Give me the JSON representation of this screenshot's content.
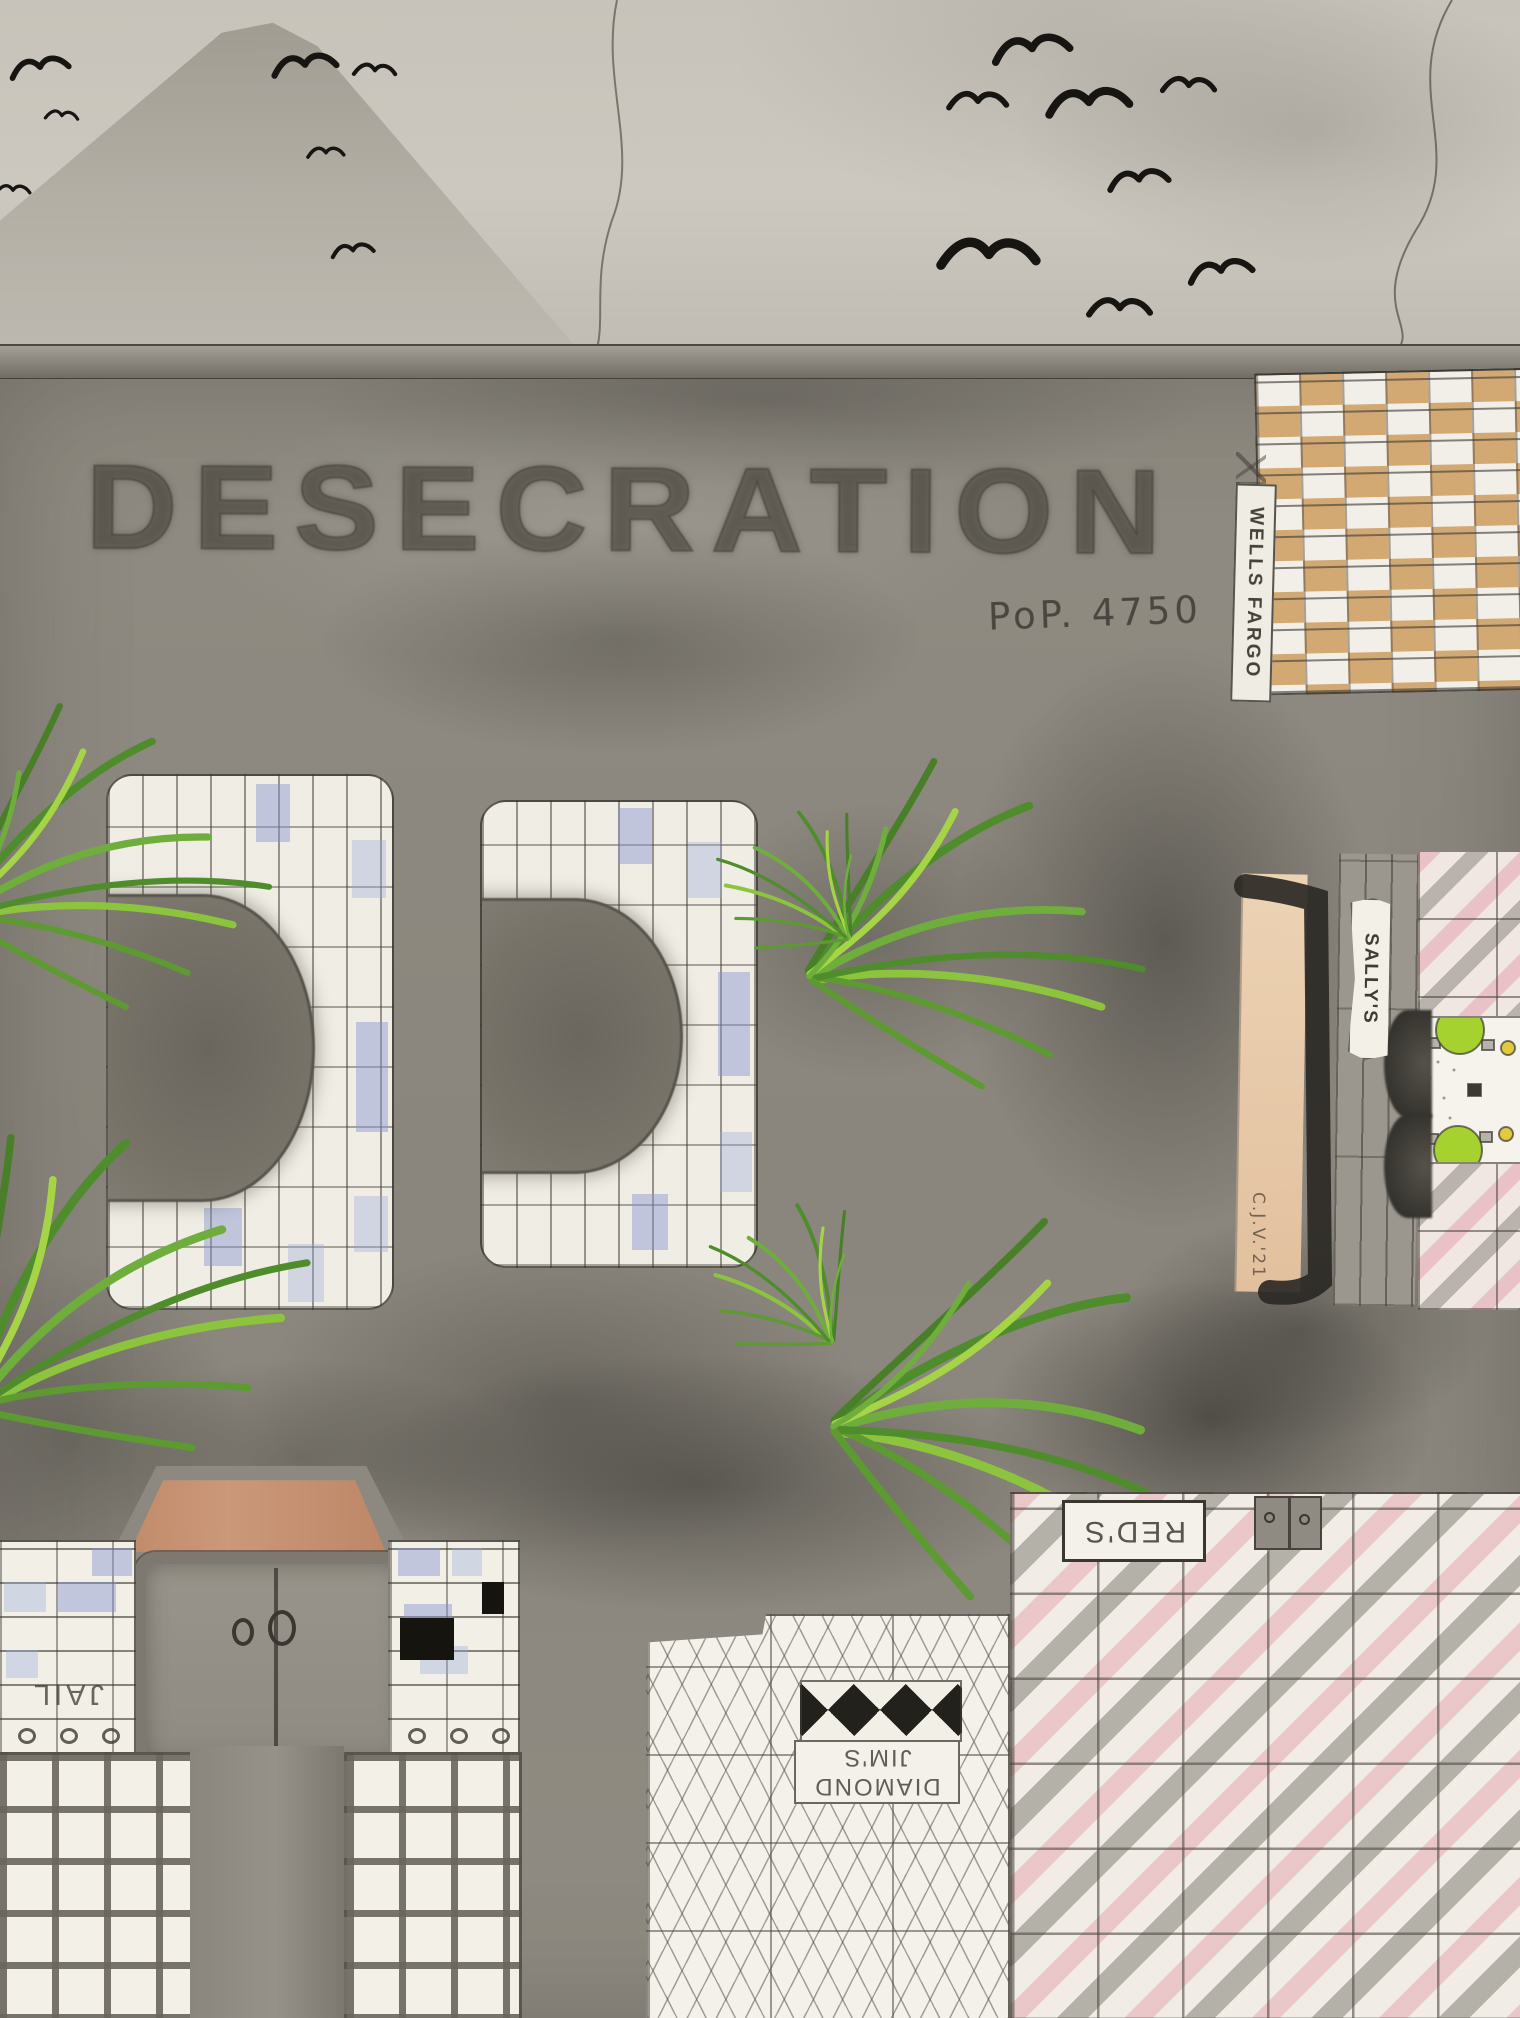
{
  "artwork": {
    "title": "DESECRATION",
    "population_label": "PoP. 4750",
    "artist_signature": "C.J.V.'21"
  },
  "buildings": {
    "wells_fargo": {
      "sign": "WELLS FARGO"
    },
    "sallys": {
      "sign": "SALLY'S"
    },
    "jail": {
      "sign": "JAIL"
    },
    "reds": {
      "sign": "RED'S"
    },
    "diamond_jims": {
      "sign_line1": "DIAMOND",
      "sign_line2": "JIM'S"
    }
  },
  "icons": {
    "bird-icon": "black ink gull silhouette (two-arc stroke)",
    "mountain-icon": "shaded graphite pyramid peak",
    "smoke-trail-icon": "thin wavy pencil smoke line",
    "plant-icon": "green colored-pencil grass tuft",
    "table-icon": "lime-green round cafe table with chairs (aerial view)",
    "door-handle-icon": "hand-drawn O door handles",
    "stagecoach-doodle-icon": "tiny pencil scribble above Wells Fargo sign"
  },
  "colors": {
    "paper_sky": "#cbc7be",
    "street_gray": "#8e8a81",
    "pencil_dark": "#3c3933",
    "title_ink": "#55524a",
    "tan_brick": "#d7a86c",
    "blue_tile": "#8c98d0",
    "pink_tile": "#e094a6",
    "plant_green": "#5f9e33",
    "lime_table": "#a6d22f",
    "yellow_item": "#e2ca3e",
    "awning_brown": "#c08a68",
    "bird_ink": "#171511"
  }
}
